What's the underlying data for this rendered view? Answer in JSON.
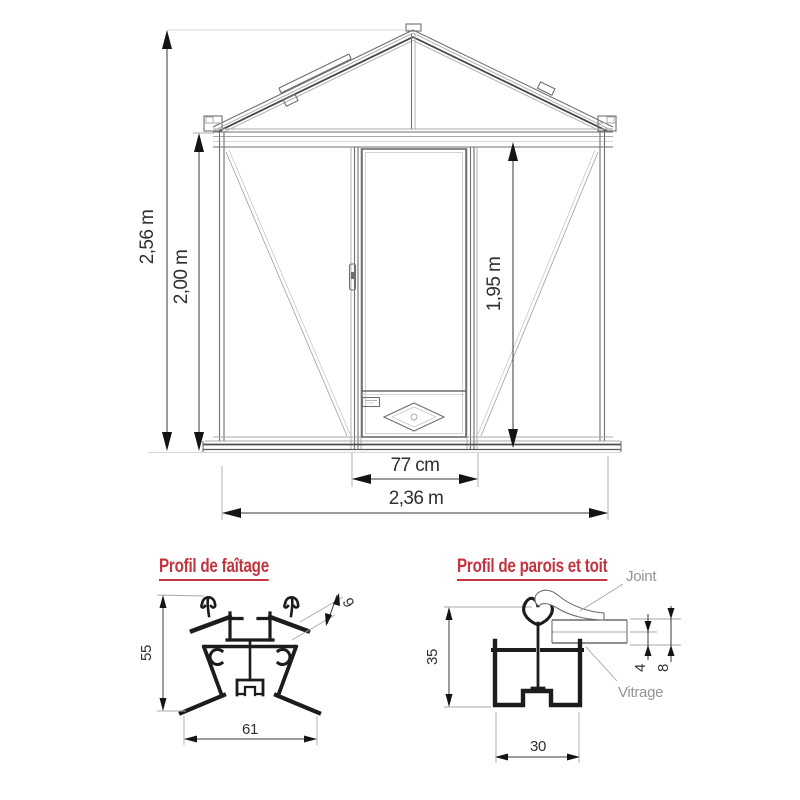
{
  "colors": {
    "background": "#ffffff",
    "title_red": "#c23440",
    "line_dark": "#2a2a2a",
    "line_mid": "#6f6f6f",
    "line_light": "#a8a8a8",
    "dim_text": "#303030",
    "label_gray": "#949494"
  },
  "front_view": {
    "dim_total_height": "2,56 m",
    "dim_wall_height": "2,00 m",
    "dim_door_height": "1,95 m",
    "dim_door_width": "77 cm",
    "dim_total_width": "2,36 m"
  },
  "ridge_profile": {
    "title": "Profil de faîtage",
    "dim_height": "55",
    "dim_width": "61",
    "dim_glazing": "9"
  },
  "wall_roof_profile": {
    "title": "Profil de parois et toit",
    "dim_height": "35",
    "dim_width": "30",
    "dim_glass": "4",
    "dim_total": "8",
    "label_joint": "Joint",
    "label_vitrage": "Vitrage"
  }
}
